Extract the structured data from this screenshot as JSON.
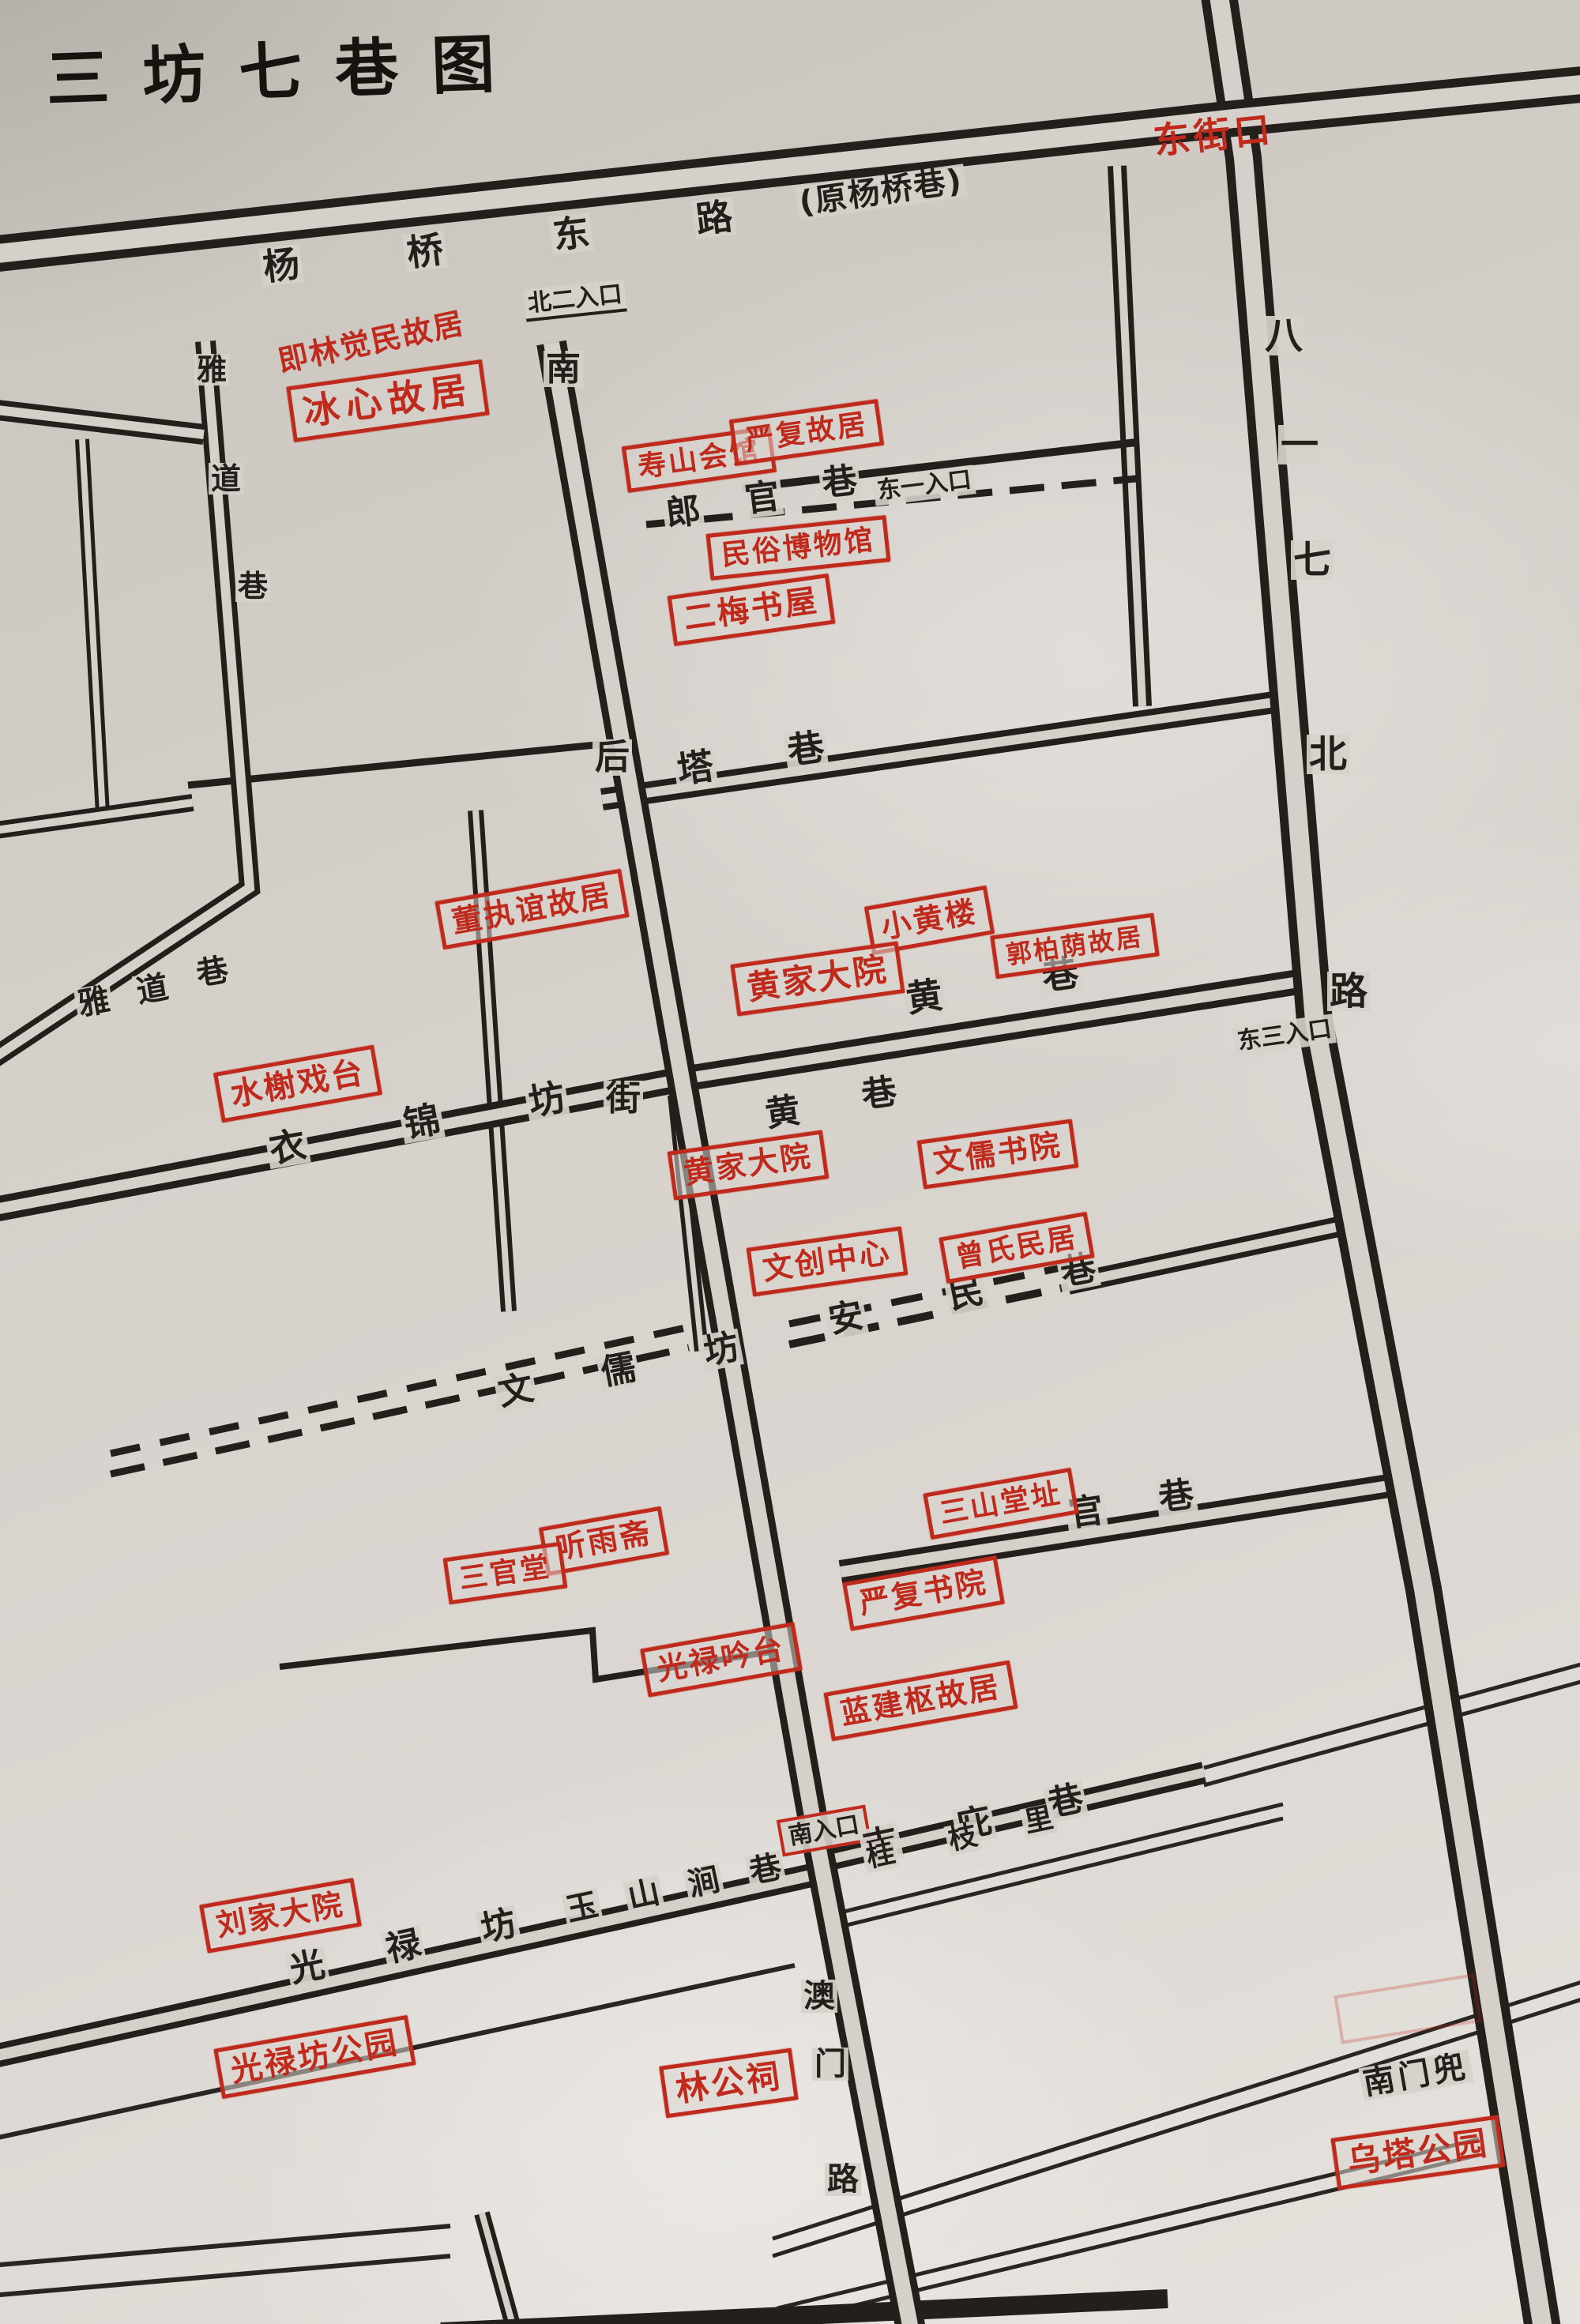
{
  "title": "三坊七巷图",
  "colors": {
    "ink": "#241f1b",
    "red": "#bf2a1c",
    "paper": "#d5d0ca"
  },
  "junction": {
    "dongjiekou": "东街口"
  },
  "note": {
    "bingxin_alias": "即林觉民故居"
  },
  "streets": {
    "yangqiao_dong_lu": {
      "name": "杨桥东路",
      "chars": [
        "杨",
        "桥",
        "东",
        "路"
      ],
      "alias": "(原杨桥巷)"
    },
    "bayiqi_bei_lu": {
      "name": "八一七北路",
      "chars": [
        "八",
        "一",
        "七",
        "北",
        "路"
      ]
    },
    "nan_hou_jie": {
      "name": "南后街",
      "chars": [
        "南",
        "后",
        "街"
      ]
    },
    "aomen_lu": {
      "name": "澳门路",
      "chars": [
        "澳",
        "门",
        "路"
      ]
    },
    "yadao_xiang": {
      "name": "雅道巷",
      "chars": [
        "雅",
        "道",
        "巷"
      ]
    },
    "langguan_xiang": {
      "name": "郎官巷",
      "chars": [
        "郎",
        "官",
        "巷"
      ]
    },
    "ta_xiang": {
      "name": "塔巷",
      "chars": [
        "塔",
        "巷"
      ]
    },
    "huang_xiang": {
      "name": "黄巷",
      "chars": [
        "黄",
        "巷"
      ]
    },
    "yijin_fang": {
      "name": "衣锦坊",
      "chars": [
        "衣",
        "锦",
        "坊"
      ]
    },
    "anmin_xiang": {
      "name": "安民巷",
      "chars": [
        "安",
        "民",
        "巷"
      ]
    },
    "wenru_fang": {
      "name": "文儒坊",
      "chars": [
        "文",
        "儒",
        "坊"
      ]
    },
    "guan_xiang": {
      "name": "官巷",
      "chars": [
        "官",
        "巷"
      ]
    },
    "jibi_xiang": {
      "name": "吉庇巷",
      "chars": [
        "吉",
        "庇",
        "巷"
      ]
    },
    "guizhi_li": {
      "name": "桂枝里",
      "chars": [
        "桂",
        "枝",
        "里"
      ]
    },
    "guanglu_fang": {
      "name": "光禄坊",
      "chars": [
        "光",
        "禄",
        "坊"
      ]
    },
    "yushanjian_xiang": {
      "name": "玉山涧巷",
      "chars": [
        "玉",
        "山",
        "涧",
        "巷"
      ]
    },
    "nanmen_dou": {
      "name": "南门兜"
    }
  },
  "entrances": {
    "north2": "北二入口",
    "east1": "东一入口",
    "east3": "东三入口",
    "south": "南入口"
  },
  "sites": {
    "bingxin": "冰心故居",
    "shoushan": "寿山会馆",
    "yanfu_guju": "严复故居",
    "minsu": "民俗博物馆",
    "ermei": "二梅书屋",
    "dongzhiyi": "董执谊故居",
    "xiaohuanglou": "小黄楼",
    "guoboyin": "郭柏荫故居",
    "huangjia_1": "黄家大院",
    "huangjia_2": "黄家大院",
    "wenru_shuyuan": "文儒书院",
    "shuixie": "水榭戏台",
    "wenchuang": "文创中心",
    "zengshi": "曾氏民居",
    "sanshantang": "三山堂址",
    "tingyuzhai": "听雨斋",
    "sanguantang": "三官堂",
    "yanfu_shuyuan": "严复书院",
    "guanglu_yintai": "光禄吟台",
    "lanjianshu": "蓝建枢故居",
    "liujia": "刘家大院",
    "guanglufang_park": "光禄坊公园",
    "lingongci": "林公祠",
    "wuta_park": "乌塔公园"
  }
}
